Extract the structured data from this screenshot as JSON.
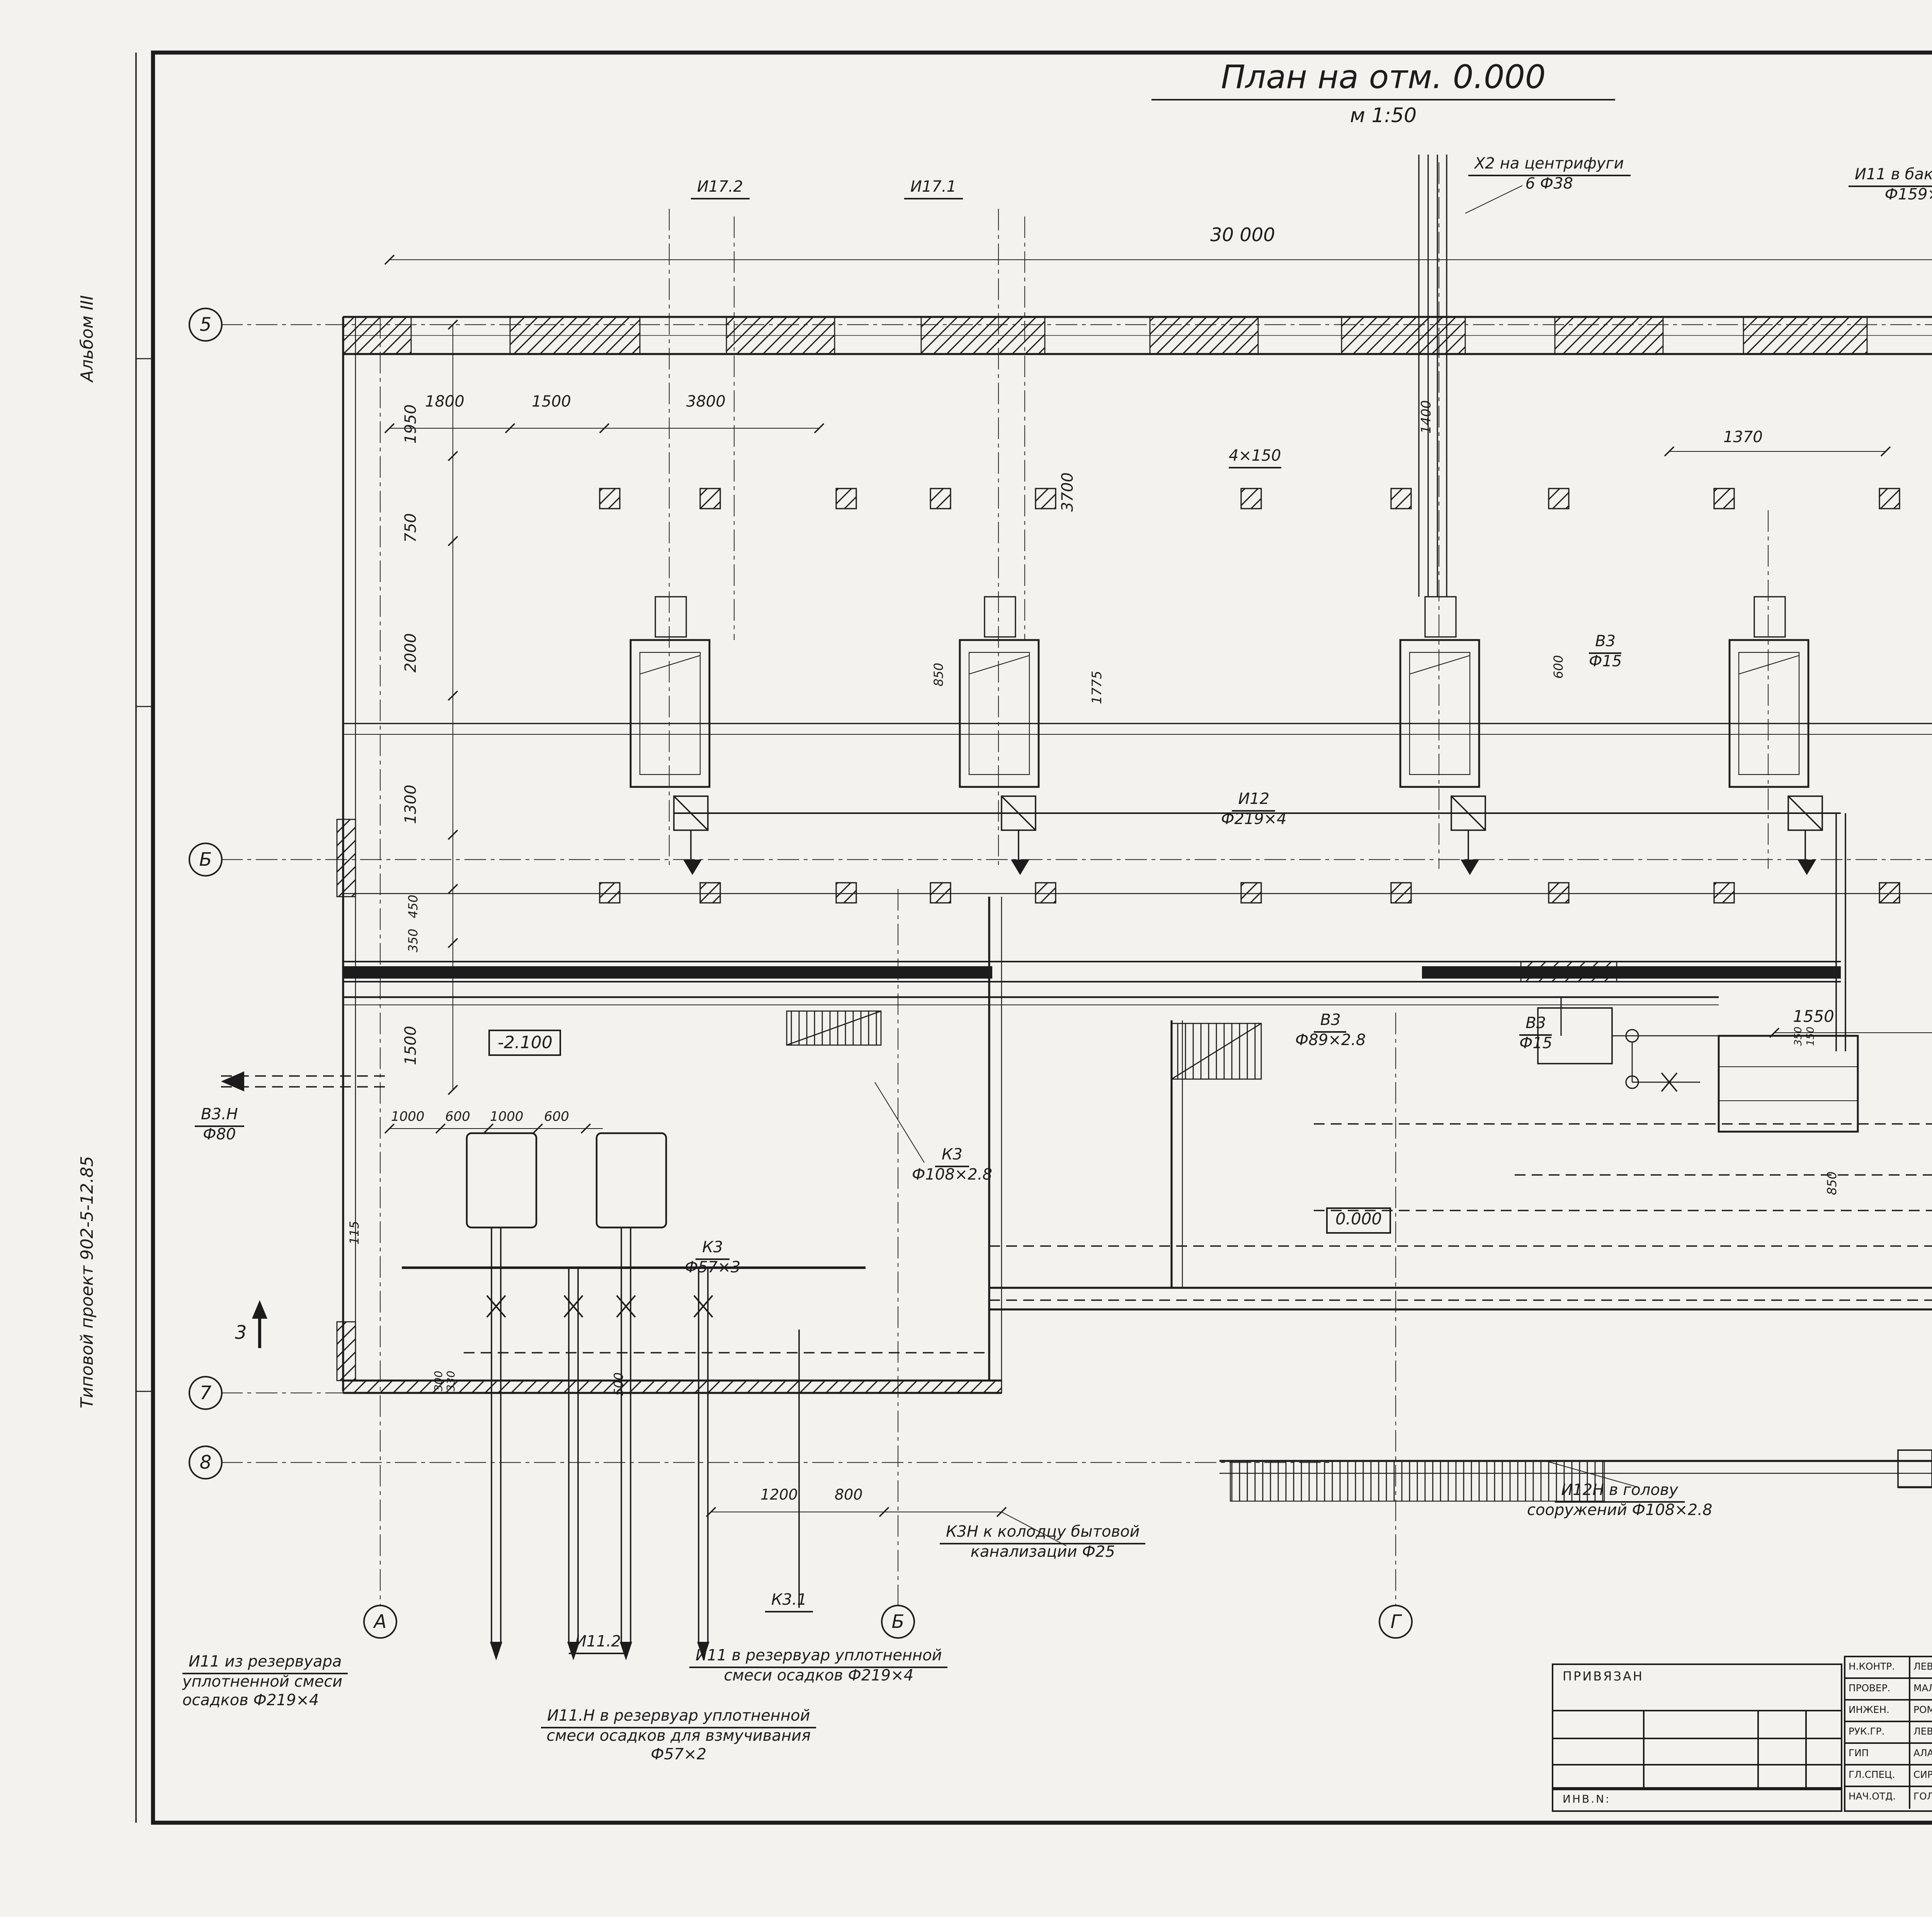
{
  "margin": {
    "album": "Альбом III",
    "project": "Типовой проект 902-5-12.85"
  },
  "title": {
    "text": "План на отм. 0.000",
    "scale": "м 1:50"
  },
  "axes": {
    "r5": "5",
    "rB": "Б",
    "r7": "7",
    "r8": "8",
    "cA": "А",
    "cB": "Б",
    "cG": "Г",
    "section": "3"
  },
  "elevations": {
    "zero": "0.000",
    "minus05": "-0.500",
    "minus21": "-2.100"
  },
  "callouts": {
    "i17_2": [
      "И17.2"
    ],
    "i17_1": [
      "И17.1"
    ],
    "x2": [
      "Х2 на центрифуги",
      "6 Ф38"
    ],
    "i11_tank": [
      "И11 в бак осадка",
      "Ф159×3.2"
    ],
    "i12": [
      "И12",
      "Ф219×4"
    ],
    "v3_15": [
      "В3",
      "Ф15"
    ],
    "v3_32": [
      "В3",
      "Ф32"
    ],
    "v3_89": [
      "В3",
      "Ф89×2.8"
    ],
    "v3n": [
      "В3.Н",
      "Ф80"
    ],
    "i8": [
      "И8 в уплотнитель",
      "Ф219×4"
    ],
    "i8n": [
      "И8Н",
      "к гидроциклону",
      "Ф219×4"
    ],
    "k3_108": [
      "К3",
      "Ф108×2.8"
    ],
    "k3_57": [
      "К3",
      "Ф57×3"
    ],
    "k3_219": [
      "К3",
      "Ф219×4"
    ],
    "k3n": [
      "К3Н к колодцу бытовой",
      "канализации Ф25"
    ],
    "k3_1": [
      "К3.1"
    ],
    "i11_2": [
      "И11.2"
    ],
    "i11_from": [
      "И11 из резервуара",
      "уплотненной смеси",
      "осадков Ф219×4"
    ],
    "i11_to": [
      "И11 в резервуар уплотненной",
      "смеси осадков Ф219×4"
    ],
    "i11n": [
      "И11.Н в резервуар уплотненной",
      "смеси осадков для взмучивания",
      "Ф57×2"
    ],
    "i12n": [
      "И12Н в голову",
      "сооружений Ф108×2.8"
    ],
    "i1n": [
      "И1Н на совместную",
      "обработку с песком из",
      "песколовок Ф89×2.8"
    ]
  },
  "dims": {
    "v30000": "30 000",
    "v1950": "1950",
    "v750": "750",
    "v2000": "2000",
    "v1300": "1300",
    "v450": "450",
    "v350": "350",
    "v1500": "1500",
    "v1800": "1800",
    "v3800": "3800",
    "v3700": "3700",
    "v850": "850",
    "v1775": "1775",
    "v4x150": "4×150",
    "v1370": "1370",
    "v1400": "1400",
    "v600": "600",
    "v2300": "2300",
    "v800": "800",
    "v1000": "1000",
    "v115": "115",
    "v95": "95",
    "v230": "230",
    "v150": "150",
    "v130": "130",
    "v500": "500",
    "v170": "170",
    "v300": "300",
    "v330": "330",
    "v100": "100",
    "v107": "107",
    "v30": "30",
    "v900": "900",
    "v700": "700",
    "v1200": "1200",
    "v1550": "1550"
  },
  "titleblock": {
    "doc": "Т.П. 902-5-12.85",
    "code": "ТХ",
    "bind_label": "ПРИВЯЗАН",
    "inv_label": "ИНВ.N:",
    "staff": [
      {
        "role": "Н.КОНТР.",
        "name": "ЛЕВИЩЕВА"
      },
      {
        "role": "ПРОВЕР.",
        "name": "МАЛЫХ"
      },
      {
        "role": "ИНЖЕН.",
        "name": "РОМАНОВА"
      },
      {
        "role": "РУК.ГР.",
        "name": "ЛЕВИЩЕВА"
      },
      {
        "role": "ГИП",
        "name": "АЛАЕВ"
      },
      {
        "role": "ГЛ.СПЕЦ.",
        "name": "СИРОТА"
      },
      {
        "role": "НАЧ.ОТД.",
        "name": "ГОЛЬДМАН"
      }
    ],
    "object_lines": [
      "КОРПУС ОБЕЗВОЖИВАНИЯ ОСАДКА",
      "СТОЧНЫХ ВОД С 6 ЦЕНТРИФУГАМИ",
      "ОГШ-501К-10"
    ],
    "stage_headers": [
      "СТАДИЯ",
      "ЛИСТ",
      "ЛИСТОВ"
    ],
    "stage": "Р.П.",
    "sheet": "5",
    "sheets_total": "",
    "drawing_lines": [
      "ЗАЛ ЦЕНТРИФУГ.",
      "План на отм. 0.000."
    ],
    "org_lines": [
      "ЦНИИЭП",
      "ИНЖЕНЕРНОГО ОБОРУДОВАНИЯ",
      "г. Москва"
    ],
    "inventory_code": "20772-02",
    "page": "8"
  }
}
